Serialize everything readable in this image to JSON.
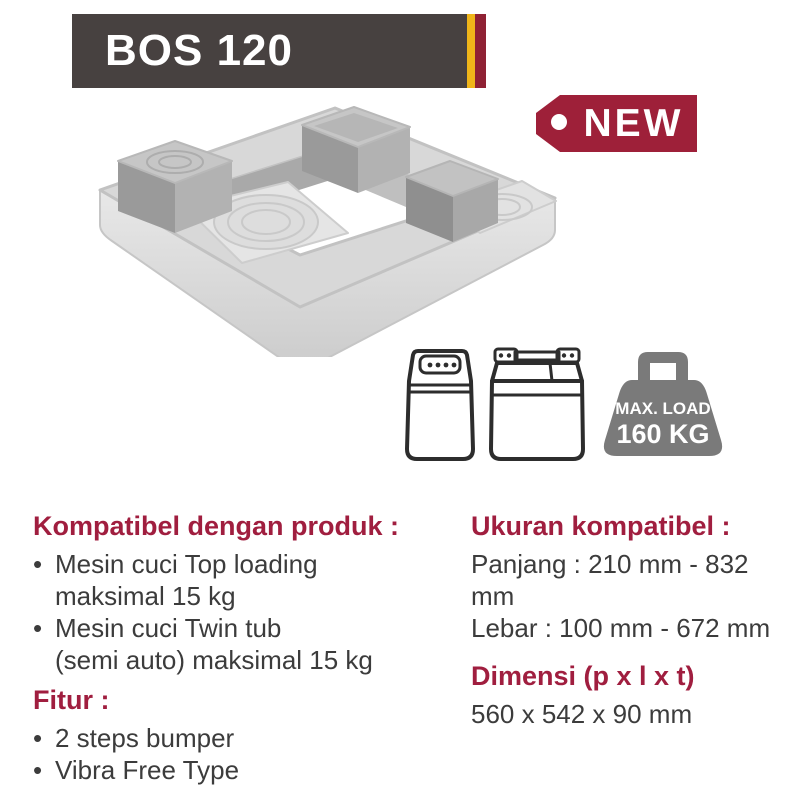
{
  "header": {
    "model": "BOS 120",
    "badge": "NEW"
  },
  "load_icon": {
    "line1": "MAX. LOAD",
    "line2": "160 KG"
  },
  "compat": {
    "heading": "Kompatibel dengan produk :",
    "items": [
      {
        "line1": "Mesin cuci Top loading",
        "line2": "maksimal 15 kg"
      },
      {
        "line1": "Mesin cuci Twin tub",
        "line2": "(semi auto) maksimal 15 kg"
      }
    ]
  },
  "fitur": {
    "heading": "Fitur :",
    "items": [
      "2 steps bumper",
      "Vibra Free Type"
    ]
  },
  "ukuran": {
    "heading": "Ukuran kompatibel :",
    "line1": "Panjang : 210 mm - 832 mm",
    "line2": "Lebar : 100 mm - 672 mm"
  },
  "dimensi": {
    "heading": "Dimensi (p x l x t)",
    "value": "560 x 542 x 90 mm"
  },
  "colors": {
    "banner_bg": "#474140",
    "stripe_yellow": "#F0B519",
    "stripe_maroon": "#8F2134",
    "tag_bg": "#9E2039",
    "heading_maroon": "#A01E3F",
    "body_text": "#3C3C3C",
    "weight_gray": "#7A7A7A",
    "product_light_gray": "#D8D8D8",
    "product_dark_gray": "#9A9A9A"
  }
}
